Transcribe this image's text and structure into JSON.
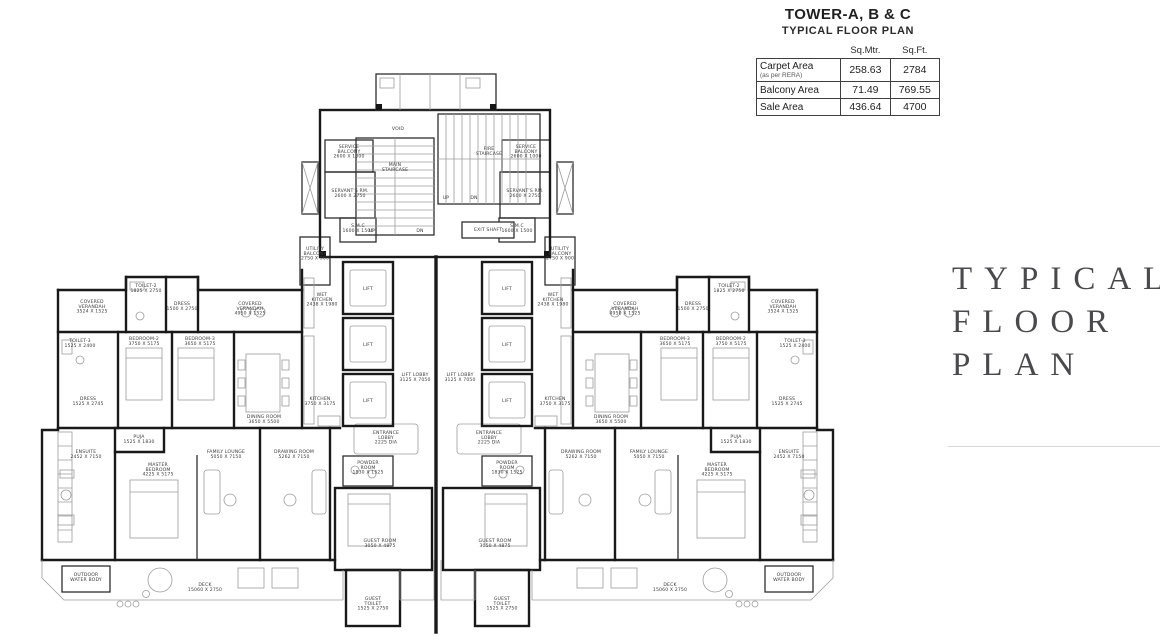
{
  "header": {
    "title": "TOWER-A, B & C",
    "subtitle": "TYPICAL FLOOR PLAN",
    "table": {
      "columns": [
        "Sq.Mtr.",
        "Sq.Ft."
      ],
      "rows": [
        {
          "label": "Carpet Area",
          "sublabel": "(as per RERA)",
          "sqmtr": "258.63",
          "sqft": "2784"
        },
        {
          "label": "Balcony Area",
          "sublabel": "",
          "sqmtr": "71.49",
          "sqft": "769.55"
        },
        {
          "label": "Sale Area",
          "sublabel": "",
          "sqmtr": "436.64",
          "sqft": "4700"
        }
      ]
    }
  },
  "side_panel": {
    "lines": [
      "TYPICAL",
      "FLOOR",
      "PLAN"
    ],
    "text_color": "#4a4a4c"
  },
  "plan": {
    "ink_color": "#191919",
    "label_color": "#3a3a3a",
    "labels": [
      {
        "t": "COVERED\nVERANDAH",
        "d": "3524 X 1525",
        "x": 92,
        "y": 303,
        "m": true
      },
      {
        "t": "TOILET-2",
        "d": "1825 X 2750",
        "x": 146,
        "y": 287,
        "m": true
      },
      {
        "t": "DRESS",
        "d": "1500 X 2750",
        "x": 182,
        "y": 305,
        "m": true
      },
      {
        "t": "COVERED\nVERANDAH",
        "d": "4950 X 1525",
        "x": 250,
        "y": 305,
        "m": true
      },
      {
        "t": "WET\nKITCHEN",
        "d": "2438 X 1980",
        "x": 322,
        "y": 296,
        "m": true
      },
      {
        "t": "TOILET-3",
        "d": "1525 X 2400",
        "x": 80,
        "y": 342,
        "m": true
      },
      {
        "t": "DRESS",
        "d": "1525 X 2745",
        "x": 88,
        "y": 400,
        "m": true
      },
      {
        "t": "BEDROOM-2",
        "d": "3750 X 5175",
        "x": 144,
        "y": 340,
        "m": true
      },
      {
        "t": "BEDROOM-3",
        "d": "3650 X 5175",
        "x": 200,
        "y": 340,
        "m": true
      },
      {
        "t": "DINING ROOM",
        "d": "3650 X 5500",
        "x": 264,
        "y": 418,
        "m": true
      },
      {
        "t": "KITCHEN",
        "d": "3750 X 3175",
        "x": 320,
        "y": 400,
        "m": true
      },
      {
        "t": "PUJA",
        "d": "1525 X 1830",
        "x": 139,
        "y": 438,
        "m": true
      },
      {
        "t": "ENSUITE",
        "d": "2452 X 7150",
        "x": 86,
        "y": 453,
        "m": true
      },
      {
        "t": "MASTER\nBEDROOM",
        "d": "4225 X 5175",
        "x": 158,
        "y": 466,
        "m": true
      },
      {
        "t": "FAMILY LOUNGE",
        "d": "5050 X 7150",
        "x": 226,
        "y": 453,
        "m": true
      },
      {
        "t": "DRAWING ROOM",
        "d": "5262 X 7150",
        "x": 294,
        "y": 453,
        "m": true
      },
      {
        "t": "SERVICE\nBALCONY",
        "d": "2600 X 1000",
        "x": 349,
        "y": 148,
        "m": true
      },
      {
        "t": "SERVANT'S RM.",
        "d": "2600 X 2750",
        "x": 350,
        "y": 192,
        "m": true
      },
      {
        "t": "S.M.C",
        "d": "1600 X 1500",
        "x": 358,
        "y": 227,
        "m": true
      },
      {
        "t": "UTILITY\nBALCONY",
        "d": "2750 X 900",
        "x": 315,
        "y": 250,
        "m": true
      },
      {
        "t": "LIFT",
        "d": "",
        "x": 368,
        "y": 290,
        "m": true
      },
      {
        "t": "LIFT",
        "d": "",
        "x": 368,
        "y": 346,
        "m": true
      },
      {
        "t": "LIFT",
        "d": "",
        "x": 368,
        "y": 402,
        "m": true
      },
      {
        "t": "LIFT LOBBY",
        "d": "3125 X 7050",
        "x": 415,
        "y": 376,
        "m": true
      },
      {
        "t": "ENTRANCE\nLOBBY",
        "d": "2225 DIA",
        "x": 386,
        "y": 434,
        "m": true
      },
      {
        "t": "POWDER\nROOM",
        "d": "1830 X 1525",
        "x": 368,
        "y": 464,
        "m": true
      },
      {
        "t": "GUEST ROOM",
        "d": "3050 X 4875",
        "x": 380,
        "y": 542,
        "m": true
      },
      {
        "t": "GUEST\nTOILET",
        "d": "1525 X 2750",
        "x": 373,
        "y": 600,
        "m": true
      },
      {
        "t": "OUTDOOR",
        "d": "WATER BODY",
        "x": 86,
        "y": 576,
        "m": true
      },
      {
        "t": "DECK",
        "d": "15060 X 2750",
        "x": 205,
        "y": 586,
        "m": true
      },
      {
        "t": "VOID",
        "d": "",
        "x": 398,
        "y": 130,
        "m": false
      },
      {
        "t": "MAIN\nSTAIRCASE",
        "d": "",
        "x": 395,
        "y": 166,
        "m": false
      },
      {
        "t": "FIRE\nSTAIRCASE",
        "d": "",
        "x": 489,
        "y": 150,
        "m": false
      },
      {
        "t": "UP",
        "d": "",
        "x": 372,
        "y": 232,
        "m": false
      },
      {
        "t": "DN",
        "d": "",
        "x": 420,
        "y": 232,
        "m": false
      },
      {
        "t": "UP",
        "d": "",
        "x": 446,
        "y": 199,
        "m": false
      },
      {
        "t": "DN",
        "d": "",
        "x": 474,
        "y": 199,
        "m": false
      },
      {
        "t": "EXIT SHAFT",
        "d": "",
        "x": 488,
        "y": 231,
        "m": false
      }
    ]
  }
}
